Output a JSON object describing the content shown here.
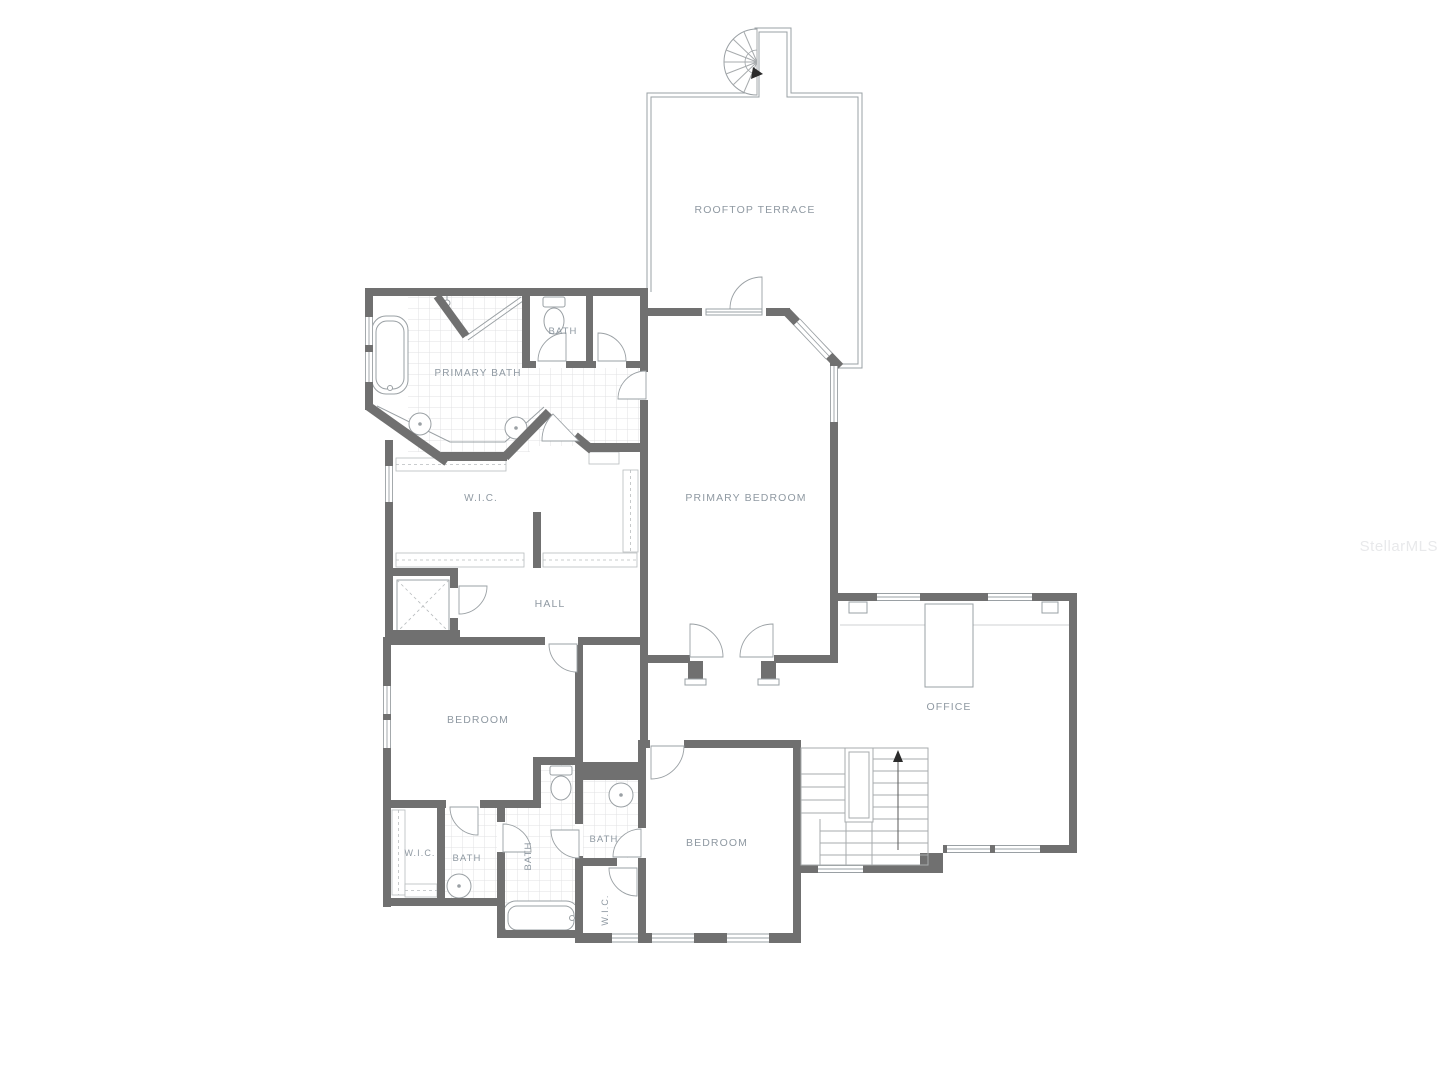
{
  "watermark": {
    "text": "StellarMLS"
  },
  "colors": {
    "wall": "#707070",
    "line": "#9aa0a4",
    "tile": "#e0e2e3",
    "label": "#8f99a2",
    "watermark": "#e8e9eb"
  },
  "rooms": [
    {
      "id": "rooftop-terrace",
      "label": "ROOFTOP TERRACE",
      "x": 755,
      "y": 213,
      "size": 10.5,
      "rotate": 0
    },
    {
      "id": "bath-upper",
      "label": "BATH",
      "x": 563,
      "y": 334,
      "size": 9.5,
      "rotate": 0
    },
    {
      "id": "primary-bath",
      "label": "PRIMARY BATH",
      "x": 478,
      "y": 376,
      "size": 10,
      "rotate": 0
    },
    {
      "id": "wic-primary",
      "label": "W.I.C.",
      "x": 481,
      "y": 501,
      "size": 10,
      "rotate": 0
    },
    {
      "id": "primary-bedroom",
      "label": "PRIMARY BEDROOM",
      "x": 746,
      "y": 501,
      "size": 10.5,
      "rotate": 0
    },
    {
      "id": "hall",
      "label": "HALL",
      "x": 550,
      "y": 607,
      "size": 10.5,
      "rotate": 0
    },
    {
      "id": "bedroom-left",
      "label": "BEDROOM",
      "x": 478,
      "y": 723,
      "size": 10.5,
      "rotate": 0
    },
    {
      "id": "office",
      "label": "OFFICE",
      "x": 949,
      "y": 710,
      "size": 10.5,
      "rotate": 0
    },
    {
      "id": "wic-left",
      "label": "W.I.C.",
      "x": 420,
      "y": 856,
      "size": 9,
      "rotate": 0
    },
    {
      "id": "bath-left",
      "label": "BATH",
      "x": 467,
      "y": 861,
      "size": 9.5,
      "rotate": 0
    },
    {
      "id": "bath-middle",
      "label": "BATH",
      "x": 531,
      "y": 856,
      "size": 9.5,
      "rotate": -90
    },
    {
      "id": "bath-right",
      "label": "BATH",
      "x": 604,
      "y": 842,
      "size": 9.5,
      "rotate": 0
    },
    {
      "id": "bedroom-bottom",
      "label": "BEDROOM",
      "x": 717,
      "y": 846,
      "size": 10.5,
      "rotate": 0
    },
    {
      "id": "wic-bottom",
      "label": "W.I.C.",
      "x": 608,
      "y": 910,
      "size": 9,
      "rotate": -90
    }
  ]
}
